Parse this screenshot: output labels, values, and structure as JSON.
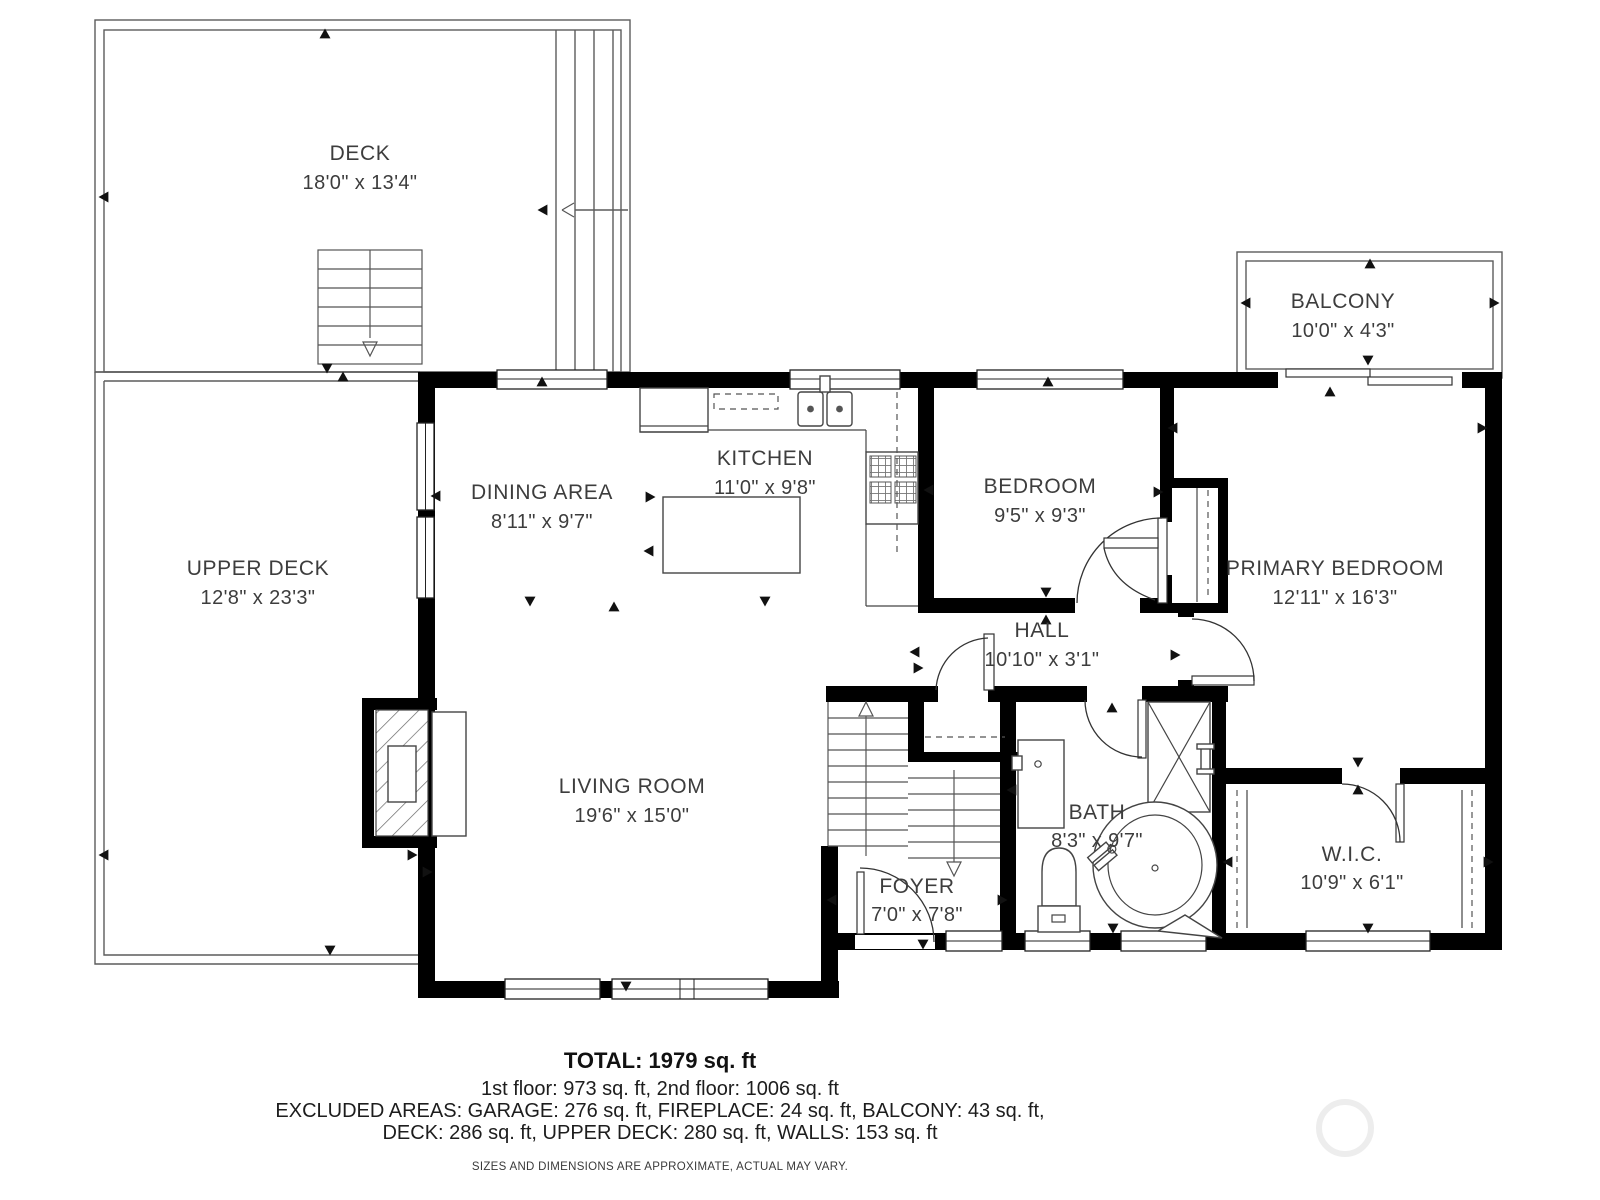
{
  "plan": {
    "rooms": [
      {
        "id": "deck",
        "name": "DECK",
        "dims": "18'0\" x 13'4\""
      },
      {
        "id": "upper-deck",
        "name": "UPPER DECK",
        "dims": "12'8\" x 23'3\""
      },
      {
        "id": "balcony",
        "name": "BALCONY",
        "dims": "10'0\" x 4'3\""
      },
      {
        "id": "dining-area",
        "name": "DINING AREA",
        "dims": "8'11\" x 9'7\""
      },
      {
        "id": "kitchen",
        "name": "KITCHEN",
        "dims": "11'0\" x 9'8\""
      },
      {
        "id": "bedroom",
        "name": "BEDROOM",
        "dims": "9'5\" x 9'3\""
      },
      {
        "id": "primary-bedroom",
        "name": "PRIMARY BEDROOM",
        "dims": "12'11\" x 16'3\""
      },
      {
        "id": "hall",
        "name": "HALL",
        "dims": "10'10\" x 3'1\""
      },
      {
        "id": "living-room",
        "name": "LIVING ROOM",
        "dims": "19'6\" x 15'0\""
      },
      {
        "id": "foyer",
        "name": "FOYER",
        "dims": "7'0\" x 7'8\""
      },
      {
        "id": "bath",
        "name": "BATH",
        "dims": "8'3\" x 9'7\""
      },
      {
        "id": "wic",
        "name": "W.I.C.",
        "dims": "10'9\" x 6'1\""
      }
    ],
    "summary": {
      "total": "TOTAL: 1979 sq. ft",
      "floors": "1st floor: 973 sq. ft, 2nd floor: 1006 sq. ft",
      "excluded1": "EXCLUDED AREAS: GARAGE: 276 sq. ft, FIREPLACE: 24 sq. ft, BALCONY: 43 sq. ft,",
      "excluded2": "DECK: 286 sq. ft, UPPER DECK: 280 sq. ft, WALLS: 153 sq. ft",
      "disclaimer": "SIZES AND DIMENSIONS ARE APPROXIMATE, ACTUAL MAY VARY."
    }
  }
}
